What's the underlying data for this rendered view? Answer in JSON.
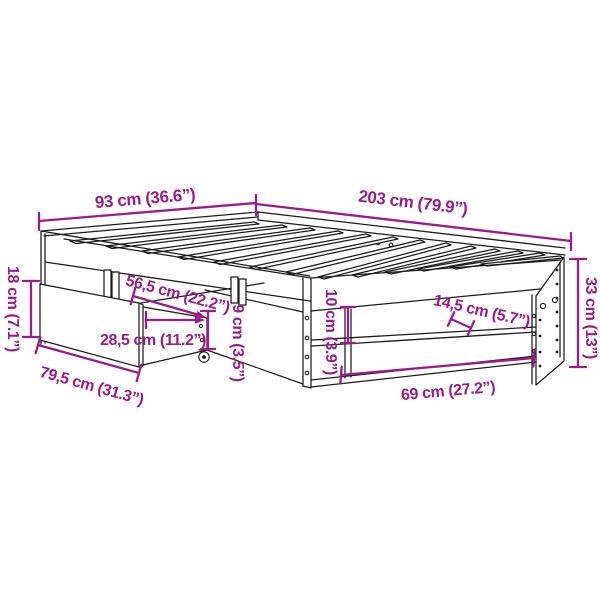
{
  "diagram": {
    "subject": "bed-frame-with-underbed-drawer-dimension-diagram",
    "background": "#ffffff",
    "accent_color": "#9a1b8a",
    "line_color": "#1b1b1b",
    "dimensions": {
      "bed_width": "93 cm (36.6”)",
      "bed_length": "203 cm (79.9”)",
      "drawer_front_height": "18 cm (7.1”)",
      "drawer_front_length": "79,5 cm (31.3”)",
      "drawer_pullout_depth": "56,5 cm (22.2”)",
      "drawer_inner_depth": "28,5 cm (11.2”)",
      "drawer_side_height": "9 cm (3.5”)",
      "under_rail_gap": "10 cm (3.9”)",
      "shelf_depth": "14,5 cm (5.7”)",
      "side_opening_length": "69 cm (27.2”)",
      "frame_side_height": "33 cm (13”)"
    }
  }
}
